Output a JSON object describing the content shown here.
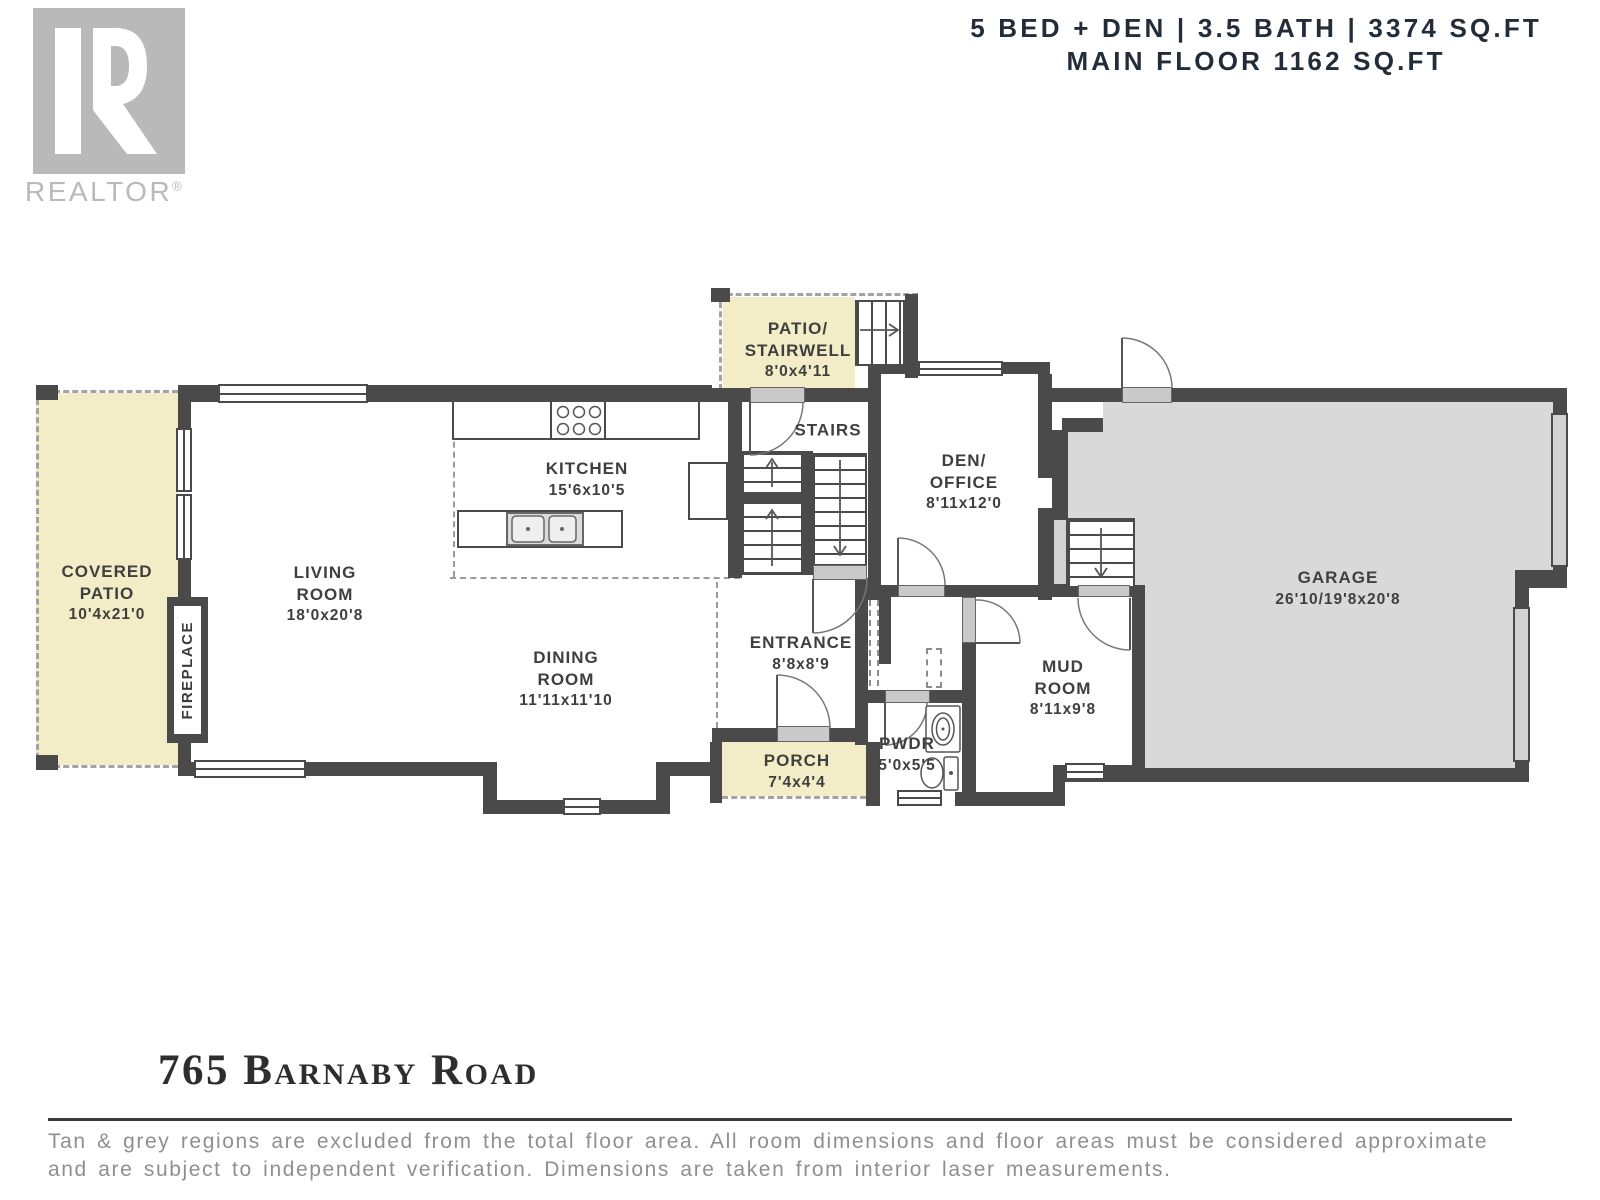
{
  "header": {
    "stats_line": "5 BED + DEN | 3.5 BATH | 3374 SQ.FT",
    "floor_line": "MAIN FLOOR 1162 SQ.FT"
  },
  "logo": {
    "brand": "REALTOR",
    "registered": "®"
  },
  "rooms": {
    "covered_patio": {
      "lines": [
        "COVERED",
        "PATIO"
      ],
      "dims": "10'4x21'0"
    },
    "living_room": {
      "lines": [
        "LIVING",
        "ROOM"
      ],
      "dims": "18'0x20'8"
    },
    "kitchen": {
      "lines": [
        "KITCHEN"
      ],
      "dims": "15'6x10'5"
    },
    "dining_room": {
      "lines": [
        "DINING",
        "ROOM"
      ],
      "dims": "11'11x11'10"
    },
    "patio_stairwell": {
      "lines": [
        "PATIO/",
        "STAIRWELL"
      ],
      "dims": "8'0x4'11"
    },
    "stairs": {
      "lines": [
        "STAIRS"
      ]
    },
    "den_office": {
      "lines": [
        "DEN/",
        "OFFICE"
      ],
      "dims": "8'11x12'0"
    },
    "entrance": {
      "lines": [
        "ENTRANCE"
      ],
      "dims": "8'8x8'9"
    },
    "porch": {
      "lines": [
        "PORCH"
      ],
      "dims": "7'4x4'4"
    },
    "pwdr": {
      "lines": [
        "PWDR"
      ],
      "dims": "5'0x5'5"
    },
    "mud_room": {
      "lines": [
        "MUD",
        "ROOM"
      ],
      "dims": "8'11x9'8"
    },
    "garage": {
      "lines": [
        "GARAGE"
      ],
      "dims": "26'10/19'8x20'8"
    },
    "fireplace": {
      "label": "FIREPLACE"
    }
  },
  "footer": {
    "address": "765 Barnaby Road",
    "disclaimer": [
      "Tan & grey regions are excluded from the total floor area. All room dimensions and floor areas must be considered approximate",
      "and are subject to independent verification. Dimensions are taken from interior laser measurements."
    ]
  },
  "colors": {
    "tan": "#f3edc7",
    "garage_grey": "#d9d9d9",
    "wall": "#4a4a4a",
    "header_text": "#232c39",
    "disclaimer_grey": "#8f8f8f",
    "logo_grey": "#b9b9b9"
  }
}
